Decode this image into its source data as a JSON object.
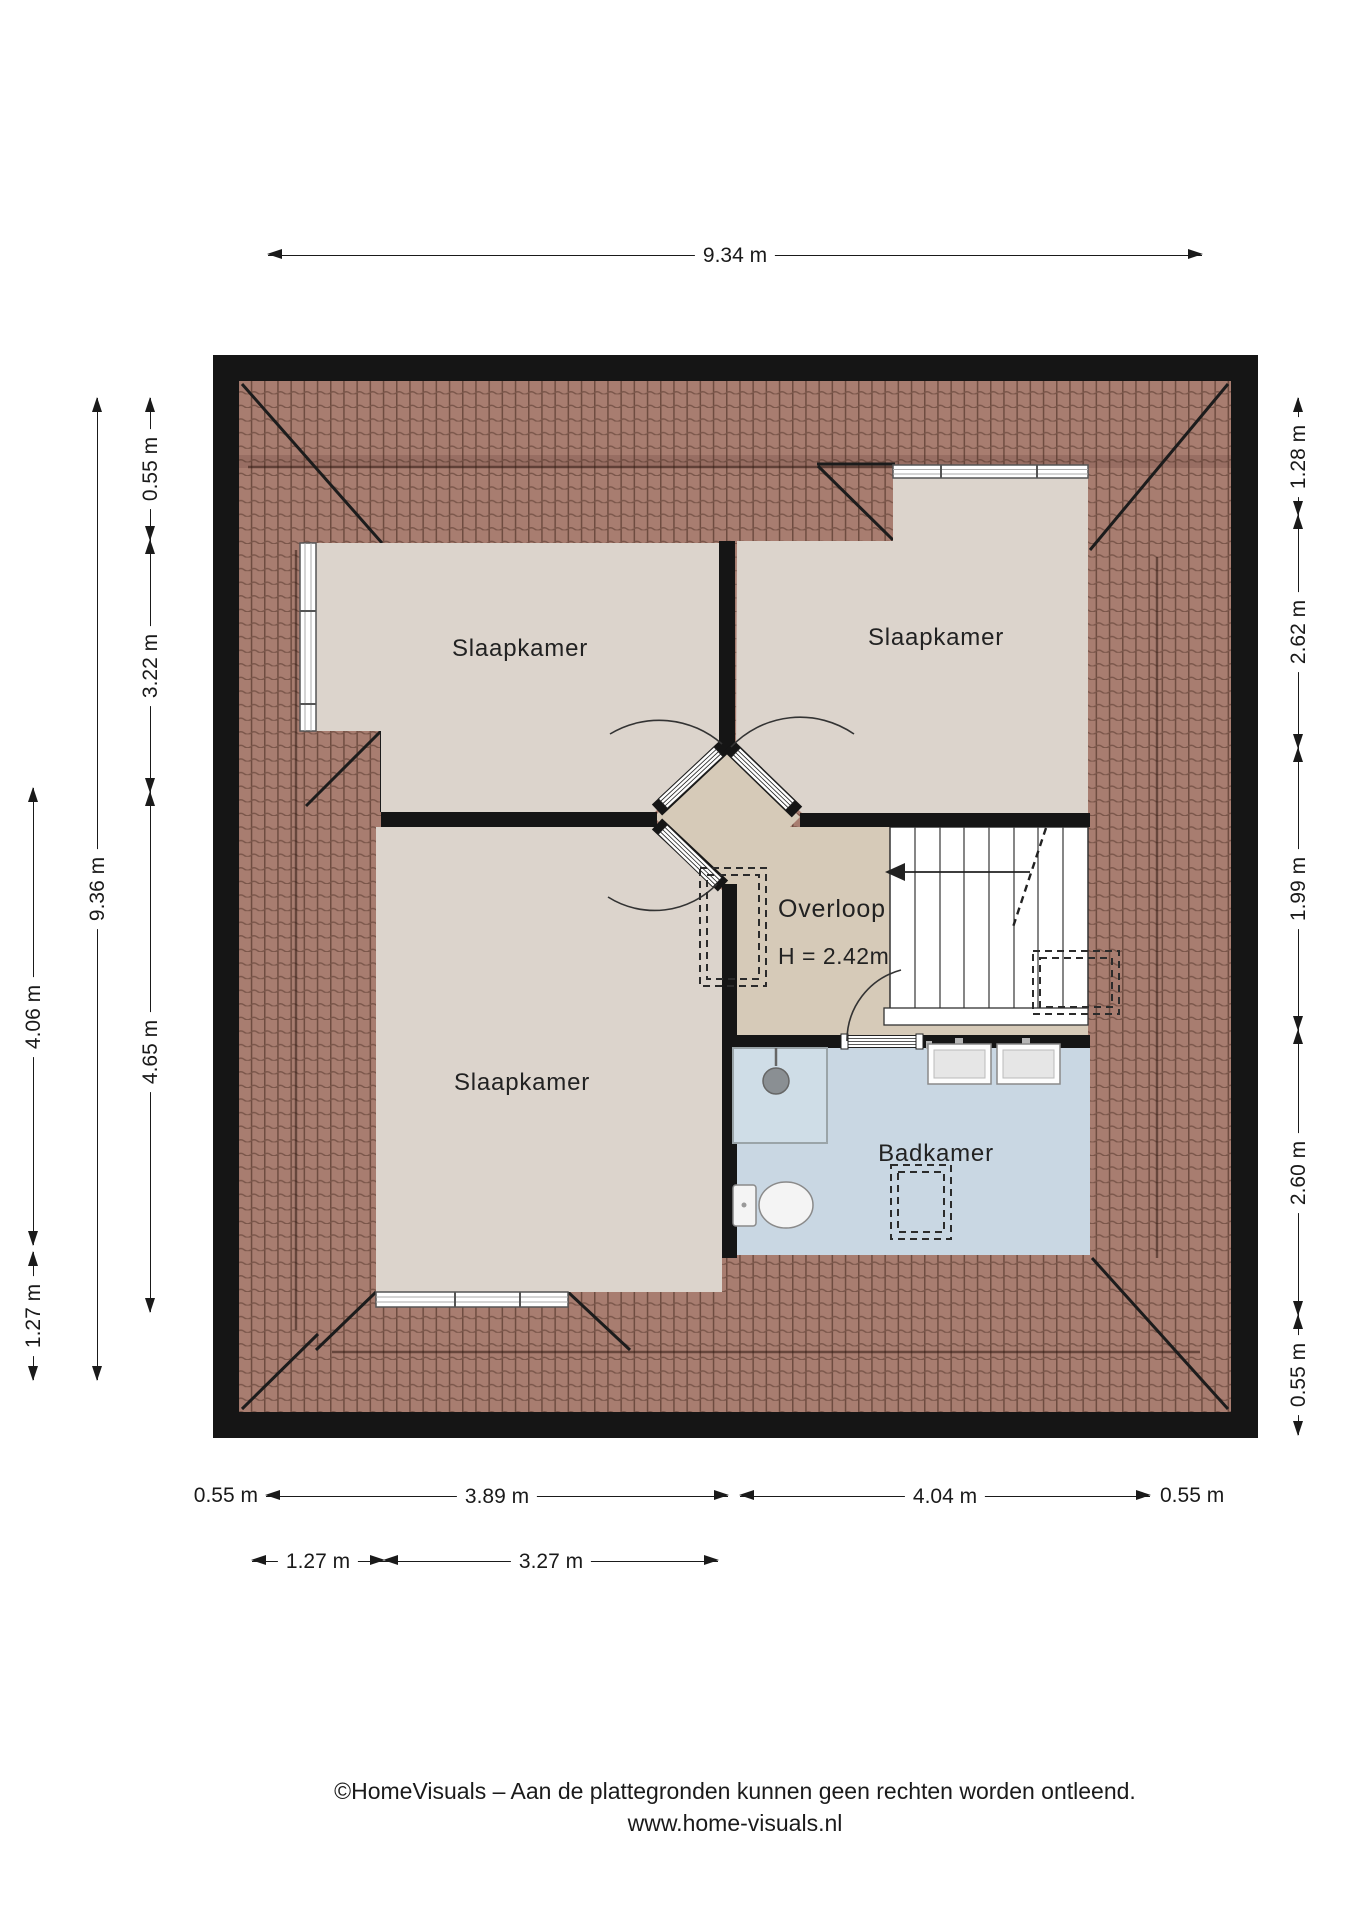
{
  "rooms": {
    "bedroom_tl": "Slaapkamer",
    "bedroom_tr": "Slaapkamer",
    "bedroom_bl": "Slaapkamer",
    "landing": "Overloop",
    "landing_height": "H = 2.42m",
    "bathroom": "Badkamer"
  },
  "dims": {
    "top": "9.34 m",
    "left_full": "9.36 m",
    "left_inner_top": "0.55 m",
    "left_inner_mid": "3.22 m",
    "left_inner_bot": "4.65 m",
    "left_outer_top": "4.06 m",
    "left_outer_bot": "1.27 m",
    "right_a": "1.28 m",
    "right_b": "2.62 m",
    "right_c": "1.99 m",
    "right_d": "2.60 m",
    "right_e": "0.55 m",
    "bot1_a": "0.55 m",
    "bot1_b": "3.89 m",
    "bot1_c": "4.04 m",
    "bot1_d": "0.55 m",
    "bot2_a": "1.27 m",
    "bot2_b": "3.27 m"
  },
  "footer": {
    "line1": "©HomeVisuals – Aan de plattegronden kunnen geen rechten worden ontleend.",
    "line2": "www.home-visuals.nl"
  },
  "colors": {
    "wall": "#151515",
    "roof_tile": "#a87d70",
    "roof_grout": "#6e4c40",
    "room_floor": "#dcd4cc",
    "landing_floor": "#d6cab8",
    "bathroom_floor": "#c9d7e3"
  }
}
